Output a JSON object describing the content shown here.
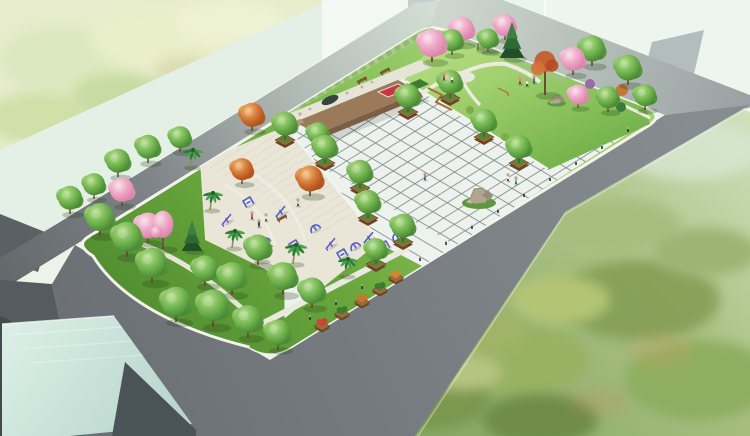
{
  "meta": {
    "description": "Aerial watercolor-style 3D rendering of a rectangular pocket-park: tiled central plaza, fitness-equipment court, cherry-blossom garden with pavilion, stage platform, tree groves, surrounded by gray roads, pale buildings and green fields"
  },
  "palette": {
    "road_dark": "#666b6e",
    "road_mid": "#7e8487",
    "road_pale": "#ccd6cc",
    "curb_white": "#f4f4ec",
    "lawn_light": "#9ed26e",
    "lawn_dark": "#4e8a2e",
    "plaza_tile": "#eef2ee",
    "plaza_grout": "#7c8c88",
    "paving_warm": "#e9e6d8",
    "stage_brown": "#9b7a5a",
    "stage_front": "#7a5f44",
    "pebble_strip": "#e6e4d6",
    "planter_brown": "#9a6a3e",
    "hedge_green": "#a9cc8a",
    "flower_red": "#cc3344",
    "bed_green": "#3e7a30",
    "equipment_blue": "#4f5fc0",
    "equipment_purple": "#6a5ac8",
    "pavilion_teal": "#b6dcdc",
    "building_mint": "#e6f2ea",
    "building_gray": "#b9c1c2",
    "field_mint": "#eaf5ee",
    "rock_gray": "#b0a58e",
    "bench_brown": "#8a5530",
    "path_white": "#eceadf"
  },
  "scene": {
    "park_features": [
      "tiled plaza",
      "fitness court",
      "blossom garden",
      "stage platform",
      "pavilion",
      "rock feature",
      "tree groves"
    ],
    "trees": [
      [
        70,
        214,
        "g",
        12,
        0
      ],
      [
        94,
        199,
        "g",
        11,
        0
      ],
      [
        118,
        177,
        "g",
        12,
        0
      ],
      [
        148,
        163,
        "g",
        12,
        0
      ],
      [
        180,
        152,
        "g",
        11,
        0
      ],
      [
        122,
        206,
        "p",
        12,
        0
      ],
      [
        252,
        131,
        "o",
        12,
        0
      ],
      [
        242,
        184,
        "o",
        11,
        0
      ],
      [
        310,
        196,
        "o",
        13,
        0
      ],
      [
        318,
        148,
        "g",
        11,
        0
      ],
      [
        100,
        236,
        "g",
        14,
        0
      ],
      [
        127,
        257,
        "g",
        15,
        0
      ],
      [
        152,
        283,
        "g",
        15,
        0
      ],
      [
        176,
        322,
        "g",
        15,
        0
      ],
      [
        213,
        327,
        "g",
        16,
        0
      ],
      [
        232,
        295,
        "g",
        14,
        0
      ],
      [
        258,
        265,
        "g",
        13,
        0
      ],
      [
        283,
        295,
        "g",
        14,
        0
      ],
      [
        312,
        308,
        "g",
        13,
        0
      ],
      [
        148,
        243,
        "p",
        13,
        0
      ],
      [
        163,
        249,
        "pt",
        13,
        0
      ],
      [
        192,
        251,
        "c",
        11,
        0
      ],
      [
        205,
        286,
        "g",
        13,
        0
      ],
      [
        248,
        338,
        "g",
        14,
        0
      ],
      [
        278,
        350,
        "g",
        13,
        0
      ],
      [
        190,
        167,
        "m",
        9,
        0
      ],
      [
        210,
        210,
        "m",
        9,
        0
      ],
      [
        232,
        248,
        "m",
        9,
        0
      ],
      [
        260,
        261,
        "m",
        9,
        0
      ],
      [
        293,
        264,
        "m",
        10,
        0
      ],
      [
        345,
        276,
        "m",
        9,
        0
      ],
      [
        285,
        140,
        "g",
        12,
        1
      ],
      [
        325,
        163,
        "g",
        12,
        1
      ],
      [
        360,
        188,
        "g",
        12,
        1
      ],
      [
        368,
        218,
        "g",
        12,
        1
      ],
      [
        376,
        264,
        "g",
        11,
        1
      ],
      [
        403,
        242,
        "g",
        12,
        1
      ],
      [
        408,
        112,
        "g",
        12,
        1
      ],
      [
        450,
        98,
        "g",
        12,
        1
      ],
      [
        484,
        137,
        "g",
        12,
        1
      ],
      [
        519,
        163,
        "g",
        12,
        1
      ],
      [
        432,
        62,
        "p",
        14,
        0
      ],
      [
        462,
        45,
        "p",
        12,
        0
      ],
      [
        505,
        40,
        "p",
        11,
        0
      ],
      [
        512,
        58,
        "c",
        13,
        0
      ],
      [
        452,
        55,
        "g",
        11,
        0
      ],
      [
        488,
        52,
        "g",
        10,
        0
      ],
      [
        545,
        95,
        "ot",
        14,
        0
      ],
      [
        573,
        75,
        "p",
        12,
        0
      ],
      [
        578,
        108,
        "p",
        10,
        0
      ],
      [
        592,
        66,
        "g",
        13,
        0
      ],
      [
        628,
        85,
        "g",
        13,
        0
      ],
      [
        645,
        110,
        "g",
        11,
        0
      ],
      [
        608,
        112,
        "g",
        11,
        0
      ]
    ],
    "people": [
      [
        508,
        181,
        "#ececec"
      ],
      [
        516,
        184,
        "#5fc8c0"
      ],
      [
        444,
        80,
        "#e05050"
      ],
      [
        452,
        82,
        "#f0eeee"
      ],
      [
        520,
        84,
        "#e08040"
      ],
      [
        527,
        86,
        "#f0eeee"
      ],
      [
        534,
        83,
        "#5878d0"
      ],
      [
        425,
        180,
        "#6888cc"
      ],
      [
        252,
        219,
        "#d06060"
      ],
      [
        259,
        227,
        "#3a4458"
      ],
      [
        266,
        221,
        "#e8e6e2"
      ],
      [
        298,
        206,
        "#c8c8c8"
      ]
    ],
    "equipment": [
      [
        250,
        205
      ],
      [
        266,
        243
      ],
      [
        282,
        214
      ],
      [
        296,
        248
      ],
      [
        316,
        230
      ],
      [
        332,
        246
      ],
      [
        344,
        257
      ],
      [
        356,
        248
      ],
      [
        370,
        240
      ],
      [
        386,
        249
      ],
      [
        398,
        238
      ],
      [
        228,
        222
      ]
    ],
    "benches": [
      [
        363,
        82
      ],
      [
        386,
        73
      ],
      [
        283,
        220
      ]
    ],
    "bollards": [
      [
        420,
        261
      ],
      [
        446,
        245
      ],
      [
        472,
        229
      ],
      [
        498,
        213
      ],
      [
        524,
        197
      ],
      [
        550,
        181
      ],
      [
        576,
        165
      ],
      [
        602,
        149
      ],
      [
        628,
        132
      ],
      [
        310,
        320
      ],
      [
        336,
        305
      ],
      [
        362,
        289
      ]
    ],
    "planter_boxes": [
      [
        322,
        326,
        "#cc4433"
      ],
      [
        342,
        314,
        "#3e7a30"
      ],
      [
        362,
        302,
        "#c8762a"
      ],
      [
        380,
        290,
        "#3e7a30"
      ],
      [
        396,
        278,
        "#cc8833"
      ]
    ],
    "rocks": [
      [
        478,
        197,
        1
      ],
      [
        556,
        100,
        0.55
      ]
    ],
    "shrubs": [
      [
        452,
        96,
        4,
        "#7fae49"
      ],
      [
        470,
        110,
        4,
        "#7fae49"
      ],
      [
        488,
        124,
        4,
        "#7fae49"
      ],
      [
        505,
        137,
        4,
        "#7fae49"
      ],
      [
        590,
        84,
        5,
        "#9a6aaa"
      ],
      [
        622,
        90,
        6,
        "#c07838"
      ],
      [
        607,
        100,
        5,
        "#3a7a3c"
      ],
      [
        621,
        107,
        5,
        "#3a7a3c"
      ],
      [
        640,
        97,
        4,
        "#4e8a3c"
      ]
    ]
  }
}
